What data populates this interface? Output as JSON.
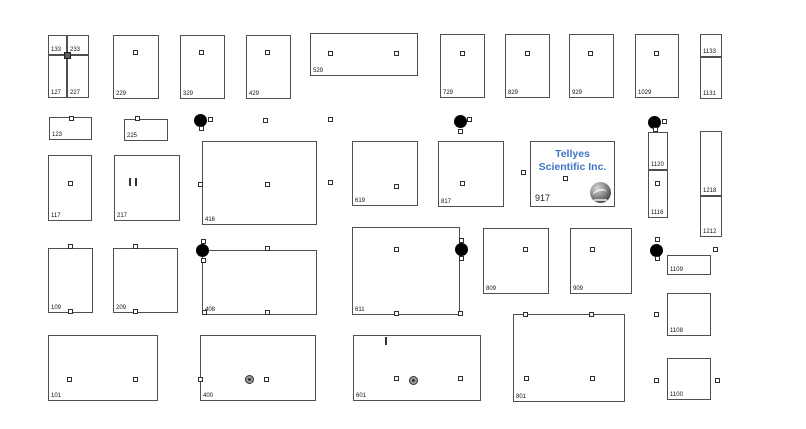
{
  "exhibitor": {
    "line1": "Tellyes",
    "line2": "Scientific Inc.",
    "number": "917",
    "name_color": "#4273c8",
    "logo": "globe-logo-icon"
  },
  "colors": {
    "booth_border": "#4f4f4f",
    "label_text": "#111111",
    "column_dot": "#000000",
    "accent_blue": "#4273c8"
  },
  "floorplan": {
    "booths": [
      {
        "label": "133",
        "x": 48,
        "y": 35,
        "w": 19,
        "h": 20
      },
      {
        "label": "233",
        "x": 67,
        "y": 35,
        "w": 22,
        "h": 20
      },
      {
        "label": "127",
        "x": 48,
        "y": 55,
        "w": 19,
        "h": 43
      },
      {
        "label": "227",
        "x": 67,
        "y": 55,
        "w": 22,
        "h": 43
      },
      {
        "label": "229",
        "x": 113,
        "y": 35,
        "w": 46,
        "h": 64
      },
      {
        "label": "329",
        "x": 180,
        "y": 35,
        "w": 45,
        "h": 64
      },
      {
        "label": "429",
        "x": 246,
        "y": 35,
        "w": 45,
        "h": 64
      },
      {
        "label": "529",
        "x": 310,
        "y": 33,
        "w": 108,
        "h": 43
      },
      {
        "label": "729",
        "x": 440,
        "y": 34,
        "w": 45,
        "h": 64
      },
      {
        "label": "829",
        "x": 505,
        "y": 34,
        "w": 45,
        "h": 64
      },
      {
        "label": "929",
        "x": 569,
        "y": 34,
        "w": 45,
        "h": 64
      },
      {
        "label": "1029",
        "x": 635,
        "y": 34,
        "w": 44,
        "h": 64
      },
      {
        "label": "1133",
        "x": 700,
        "y": 34,
        "w": 22,
        "h": 23
      },
      {
        "label": "1131",
        "x": 700,
        "y": 57,
        "w": 22,
        "h": 42
      },
      {
        "label": "123",
        "x": 49,
        "y": 117,
        "w": 43,
        "h": 23
      },
      {
        "label": "225",
        "x": 124,
        "y": 119,
        "w": 44,
        "h": 22
      },
      {
        "label": "117",
        "x": 48,
        "y": 155,
        "w": 44,
        "h": 66
      },
      {
        "label": "217",
        "x": 114,
        "y": 155,
        "w": 66,
        "h": 66
      },
      {
        "label": "416",
        "x": 202,
        "y": 141,
        "w": 115,
        "h": 84
      },
      {
        "label": "619",
        "x": 352,
        "y": 141,
        "w": 66,
        "h": 65
      },
      {
        "label": "817",
        "x": 438,
        "y": 141,
        "w": 66,
        "h": 66
      },
      {
        "label": "1120",
        "x": 648,
        "y": 132,
        "w": 20,
        "h": 38
      },
      {
        "label": "1116",
        "x": 648,
        "y": 170,
        "w": 20,
        "h": 48
      },
      {
        "label": "1218",
        "x": 700,
        "y": 131,
        "w": 22,
        "h": 65
      },
      {
        "label": "1212",
        "x": 700,
        "y": 196,
        "w": 22,
        "h": 41
      },
      {
        "label": "109",
        "x": 48,
        "y": 248,
        "w": 45,
        "h": 65
      },
      {
        "label": "209",
        "x": 113,
        "y": 248,
        "w": 65,
        "h": 65
      },
      {
        "label": "408",
        "x": 202,
        "y": 250,
        "w": 115,
        "h": 65
      },
      {
        "label": "611",
        "x": 352,
        "y": 227,
        "w": 108,
        "h": 88
      },
      {
        "label": "809",
        "x": 483,
        "y": 228,
        "w": 66,
        "h": 66
      },
      {
        "label": "909",
        "x": 570,
        "y": 228,
        "w": 62,
        "h": 66
      },
      {
        "label": "1109",
        "x": 667,
        "y": 255,
        "w": 44,
        "h": 20
      },
      {
        "label": "101",
        "x": 48,
        "y": 335,
        "w": 110,
        "h": 66
      },
      {
        "label": "400",
        "x": 200,
        "y": 335,
        "w": 116,
        "h": 66
      },
      {
        "label": "601",
        "x": 353,
        "y": 335,
        "w": 128,
        "h": 66
      },
      {
        "label": "801",
        "x": 513,
        "y": 314,
        "w": 112,
        "h": 88
      },
      {
        "label": "1108",
        "x": 667,
        "y": 293,
        "w": 44,
        "h": 43
      },
      {
        "label": "1100",
        "x": 667,
        "y": 358,
        "w": 44,
        "h": 42
      }
    ],
    "markers": [
      {
        "t": "dk",
        "x": 67,
        "y": 55
      },
      {
        "t": "sq",
        "x": 135,
        "y": 52
      },
      {
        "t": "sq",
        "x": 201,
        "y": 52
      },
      {
        "t": "sq",
        "x": 267,
        "y": 52
      },
      {
        "t": "sq",
        "x": 330,
        "y": 53
      },
      {
        "t": "sq",
        "x": 396,
        "y": 53
      },
      {
        "t": "sq",
        "x": 462,
        "y": 53
      },
      {
        "t": "sq",
        "x": 527,
        "y": 53
      },
      {
        "t": "sq",
        "x": 590,
        "y": 53
      },
      {
        "t": "sq",
        "x": 656,
        "y": 53
      },
      {
        "t": "sq",
        "x": 71,
        "y": 118
      },
      {
        "t": "sq",
        "x": 137,
        "y": 118
      },
      {
        "t": "dot",
        "x": 200,
        "y": 120
      },
      {
        "t": "sq",
        "x": 210,
        "y": 119
      },
      {
        "t": "sq",
        "x": 201,
        "y": 128
      },
      {
        "t": "sq",
        "x": 265,
        "y": 120
      },
      {
        "t": "sq",
        "x": 330,
        "y": 119
      },
      {
        "t": "dot",
        "x": 460,
        "y": 121
      },
      {
        "t": "sq",
        "x": 469,
        "y": 119
      },
      {
        "t": "sq",
        "x": 460,
        "y": 131
      },
      {
        "t": "dot",
        "x": 654,
        "y": 122
      },
      {
        "t": "sq",
        "x": 664,
        "y": 121
      },
      {
        "t": "sq",
        "x": 655,
        "y": 129
      },
      {
        "t": "sq",
        "x": 70,
        "y": 183
      },
      {
        "t": "dticks",
        "x": 133,
        "y": 182
      },
      {
        "t": "sq",
        "x": 200,
        "y": 184
      },
      {
        "t": "sq",
        "x": 267,
        "y": 184
      },
      {
        "t": "sq",
        "x": 330,
        "y": 182
      },
      {
        "t": "sq",
        "x": 396,
        "y": 186
      },
      {
        "t": "sq",
        "x": 462,
        "y": 183
      },
      {
        "t": "sq",
        "x": 523,
        "y": 172
      },
      {
        "t": "sq",
        "x": 565,
        "y": 178
      },
      {
        "t": "sq",
        "x": 657,
        "y": 183
      },
      {
        "t": "sq",
        "x": 70,
        "y": 246
      },
      {
        "t": "sq",
        "x": 70,
        "y": 311
      },
      {
        "t": "sq",
        "x": 135,
        "y": 246
      },
      {
        "t": "sq",
        "x": 135,
        "y": 311
      },
      {
        "t": "dot",
        "x": 202,
        "y": 250
      },
      {
        "t": "sq",
        "x": 203,
        "y": 241
      },
      {
        "t": "sq",
        "x": 203,
        "y": 260
      },
      {
        "t": "sq",
        "x": 267,
        "y": 248
      },
      {
        "t": "sq",
        "x": 204,
        "y": 312
      },
      {
        "t": "sq",
        "x": 267,
        "y": 312
      },
      {
        "t": "sq",
        "x": 396,
        "y": 249
      },
      {
        "t": "sq",
        "x": 396,
        "y": 313
      },
      {
        "t": "sq",
        "x": 460,
        "y": 313
      },
      {
        "t": "dot",
        "x": 461,
        "y": 249
      },
      {
        "t": "sq",
        "x": 461,
        "y": 240
      },
      {
        "t": "sq",
        "x": 461,
        "y": 258
      },
      {
        "t": "sq",
        "x": 525,
        "y": 249
      },
      {
        "t": "sq",
        "x": 592,
        "y": 249
      },
      {
        "t": "dot",
        "x": 656,
        "y": 250
      },
      {
        "t": "sq",
        "x": 657,
        "y": 239
      },
      {
        "t": "sq",
        "x": 657,
        "y": 258
      },
      {
        "t": "sq",
        "x": 715,
        "y": 249
      },
      {
        "t": "sq",
        "x": 69,
        "y": 379
      },
      {
        "t": "sq",
        "x": 135,
        "y": 379
      },
      {
        "t": "sq",
        "x": 200,
        "y": 379
      },
      {
        "t": "col",
        "x": 249,
        "y": 379
      },
      {
        "t": "sq",
        "x": 266,
        "y": 379
      },
      {
        "t": "tick",
        "x": 386,
        "y": 341
      },
      {
        "t": "sq",
        "x": 396,
        "y": 378
      },
      {
        "t": "col",
        "x": 413,
        "y": 380
      },
      {
        "t": "sq",
        "x": 460,
        "y": 378
      },
      {
        "t": "sq",
        "x": 525,
        "y": 314
      },
      {
        "t": "sq",
        "x": 591,
        "y": 314
      },
      {
        "t": "sq",
        "x": 526,
        "y": 378
      },
      {
        "t": "sq",
        "x": 592,
        "y": 378
      },
      {
        "t": "sq",
        "x": 656,
        "y": 314
      },
      {
        "t": "sq",
        "x": 656,
        "y": 380
      },
      {
        "t": "sq",
        "x": 717,
        "y": 380
      }
    ]
  }
}
